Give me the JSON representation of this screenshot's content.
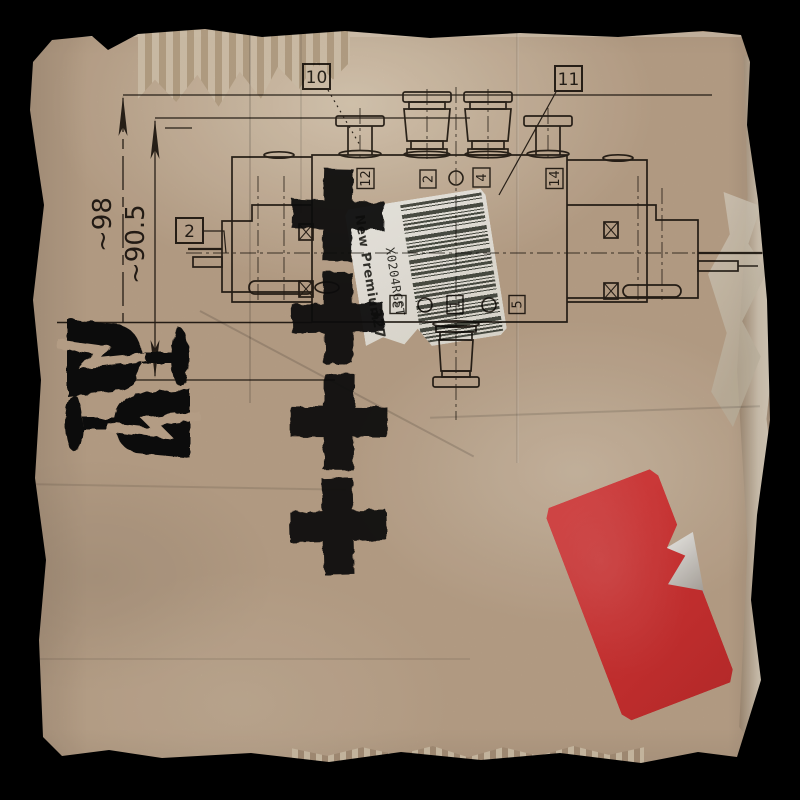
{
  "scene": {
    "background_color": "#000000",
    "cardboard_color": "#bfa68c",
    "ink_color": "#221c14",
    "description": "pneumatic solenoid valve technical drawing printed on torn cardboard"
  },
  "drawing": {
    "dimensions": {
      "height_overall": "~98",
      "height_secondary": "~90.5"
    },
    "callouts": {
      "c10": "10",
      "c11": "11",
      "c2": "2"
    },
    "ports_top": [
      "12",
      "2",
      "4",
      "14"
    ],
    "ports_bottom": [
      "3",
      "1",
      "5"
    ]
  },
  "barcode_sticker": {
    "brand": "New Premium",
    "number": "327",
    "code": "X0204RGST"
  },
  "stamps": {
    "cross_count": 4,
    "fragile_glass_count": 2,
    "stamp_color": "#0b0a09"
  },
  "red_sticker": {
    "color": "#d63434"
  }
}
